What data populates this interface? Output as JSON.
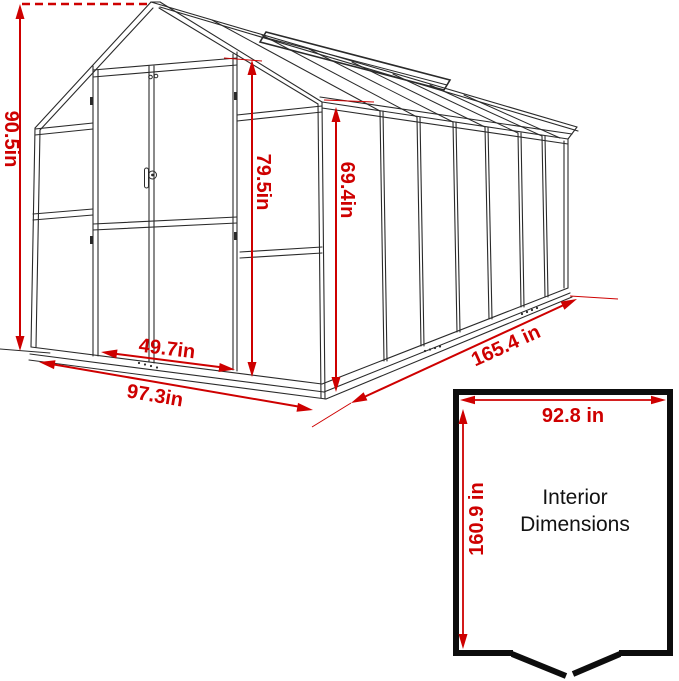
{
  "diagram": {
    "colors": {
      "dimension_red": "#ce0000",
      "line_black": "#232323"
    },
    "exterior": {
      "overall_height": "90.5in",
      "door_height": "79.5in",
      "side_wall_height": "69.4in",
      "door_width": "49.7in",
      "front_width": "97.3in",
      "side_length": "165.4 in"
    },
    "interior": {
      "width": "92.8 in",
      "depth": "160.9 in",
      "title_line1": "Interior",
      "title_line2": "Dimensions"
    }
  }
}
